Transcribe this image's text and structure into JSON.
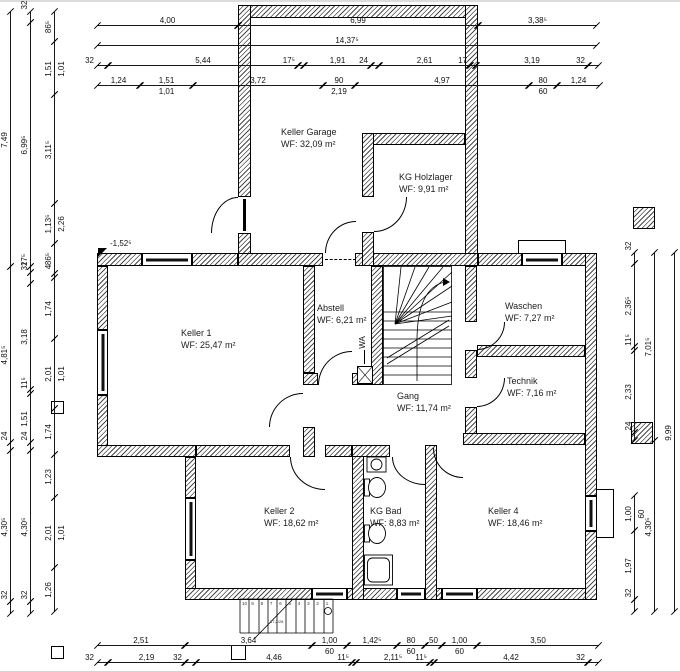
{
  "colors": {
    "line": "#000000",
    "hatch": "#4a4a4a",
    "background": "#ffffff",
    "text": "#222222"
  },
  "rooms": [
    {
      "name": "Keller Garage",
      "area": "WF: 32,09 m²"
    },
    {
      "name": "KG Holzlager",
      "area": "WF:  9,91 m²"
    },
    {
      "name": "Keller 1",
      "area": "WF: 25,47 m²"
    },
    {
      "name": "Abstell",
      "area": "WF: 6,21 m²"
    },
    {
      "name": "Waschen",
      "area": "WF: 7,27 m²"
    },
    {
      "name": "Technik",
      "area": "WF: 7,16 m²"
    },
    {
      "name": "Gang",
      "area": "WF: 11,74 m²"
    },
    {
      "name": "Keller 2",
      "area": "WF: 18,62 m²"
    },
    {
      "name": "KG Bad",
      "area": "WF: 8,83 m²"
    },
    {
      "name": "Keller 4",
      "area": "WF: 18,46 m²"
    }
  ],
  "annotations": {
    "level_marker": "-1,52⁵",
    "wa": "WA",
    "stair_note": "17,2/28",
    "ext_stair_steps": [
      "10",
      "9",
      "8",
      "7",
      "6",
      "5",
      "4",
      "3",
      "2",
      "1"
    ]
  },
  "dimensions": {
    "h_rows": [
      {
        "y": 25,
        "segs": [
          [
            97,
            238,
            "4,00"
          ],
          [
            238,
            478,
            "6,99"
          ],
          [
            478,
            597,
            "3,38⁵"
          ]
        ]
      },
      {
        "y": 45,
        "segs": [
          [
            97,
            597,
            "14,37⁵"
          ]
        ]
      },
      {
        "y": 65,
        "segs": [
          [
            97,
            108,
            "32"
          ],
          [
            108,
            298,
            "5,44"
          ],
          [
            298,
            304,
            "17⁵"
          ],
          [
            304,
            371,
            "1,91"
          ],
          [
            371,
            379,
            "24"
          ],
          [
            379,
            470,
            "2,61"
          ],
          [
            470,
            476,
            "17"
          ],
          [
            476,
            588,
            "3,19"
          ],
          [
            588,
            599,
            "32"
          ]
        ]
      },
      {
        "y": 85,
        "segs": [
          [
            97,
            140,
            "1,24"
          ],
          [
            140,
            193,
            "1,51",
            "1,01"
          ],
          [
            193,
            323,
            "3,72"
          ],
          [
            323,
            355,
            "90",
            "2,19"
          ],
          [
            355,
            529,
            "4,97"
          ],
          [
            529,
            557,
            "80",
            "60"
          ],
          [
            557,
            600,
            "1,24"
          ]
        ]
      },
      {
        "y": 645,
        "segs": [
          [
            97,
            185,
            "2,51"
          ],
          [
            185,
            312,
            "3,64"
          ],
          [
            312,
            347,
            "1,00",
            "60"
          ],
          [
            347,
            397,
            "1,42⁵"
          ],
          [
            397,
            425,
            "80",
            "60"
          ],
          [
            425,
            442,
            "50"
          ],
          [
            442,
            477,
            "1,00",
            "60"
          ],
          [
            477,
            599,
            "3,50"
          ]
        ]
      },
      {
        "y": 662,
        "segs": [
          [
            97,
            108,
            "32"
          ],
          [
            108,
            185,
            "2,19"
          ],
          [
            185,
            196,
            "32"
          ],
          [
            196,
            352,
            "4,46"
          ],
          [
            352,
            356,
            "11⁵"
          ],
          [
            356,
            430,
            "2,11⁵"
          ],
          [
            430,
            434,
            "11⁵"
          ],
          [
            434,
            588,
            "4,42"
          ],
          [
            588,
            599,
            "32"
          ]
        ]
      }
    ],
    "v_cols": [
      {
        "x": 10,
        "segs": [
          [
            12,
            267,
            "7,49"
          ],
          [
            267,
            443,
            "4,81⁵"
          ],
          [
            443,
            451,
            "24"
          ],
          [
            451,
            602,
            "4,30⁵"
          ],
          [
            602,
            614,
            "32"
          ]
        ]
      },
      {
        "x": 30,
        "segs": [
          [
            12,
            23,
            "32"
          ],
          [
            23,
            267,
            "6,99⁵"
          ],
          [
            267,
            273,
            "17⁵"
          ],
          [
            273,
            284,
            "32"
          ],
          [
            284,
            390,
            "3,18"
          ],
          [
            390,
            394,
            "11⁵"
          ],
          [
            394,
            443,
            "1,51"
          ],
          [
            443,
            451,
            "24"
          ],
          [
            451,
            602,
            "4,30⁵"
          ],
          [
            602,
            614,
            "32"
          ]
        ]
      },
      {
        "x": 54,
        "segs": [
          [
            12,
            42,
            "86⁵"
          ],
          [
            42,
            95,
            "1,51",
            "1,01"
          ],
          [
            95,
            204,
            "3,11⁵"
          ],
          [
            204,
            244,
            "1,13⁵",
            "2,26"
          ],
          [
            244,
            274,
            "86⁵"
          ],
          [
            274,
            278,
            "4"
          ],
          [
            278,
            339,
            "1,74"
          ],
          [
            339,
            409,
            "2,01",
            "1,01"
          ],
          [
            409,
            455,
            "1,74"
          ],
          [
            455,
            498,
            "1,23"
          ],
          [
            498,
            568,
            "2,01",
            "1,01"
          ],
          [
            568,
            612,
            "1,26"
          ]
        ]
      },
      {
        "x": 634,
        "segs": [
          [
            253,
            264,
            "32"
          ],
          [
            264,
            347,
            "2,36⁵"
          ],
          [
            347,
            351,
            "11⁵"
          ],
          [
            351,
            433,
            "2,33"
          ],
          [
            433,
            441,
            "24"
          ],
          [
            496,
            531,
            "1,00",
            "60"
          ],
          [
            531,
            600,
            "1,97"
          ],
          [
            600,
            612,
            "32"
          ]
        ]
      },
      {
        "x": 654,
        "segs": [
          [
            253,
            441,
            "7,01⁵"
          ],
          [
            441,
            612,
            "4,30⁵"
          ]
        ]
      },
      {
        "x": 674,
        "segs": [
          [
            253,
            612,
            "9,99"
          ]
        ]
      }
    ]
  }
}
